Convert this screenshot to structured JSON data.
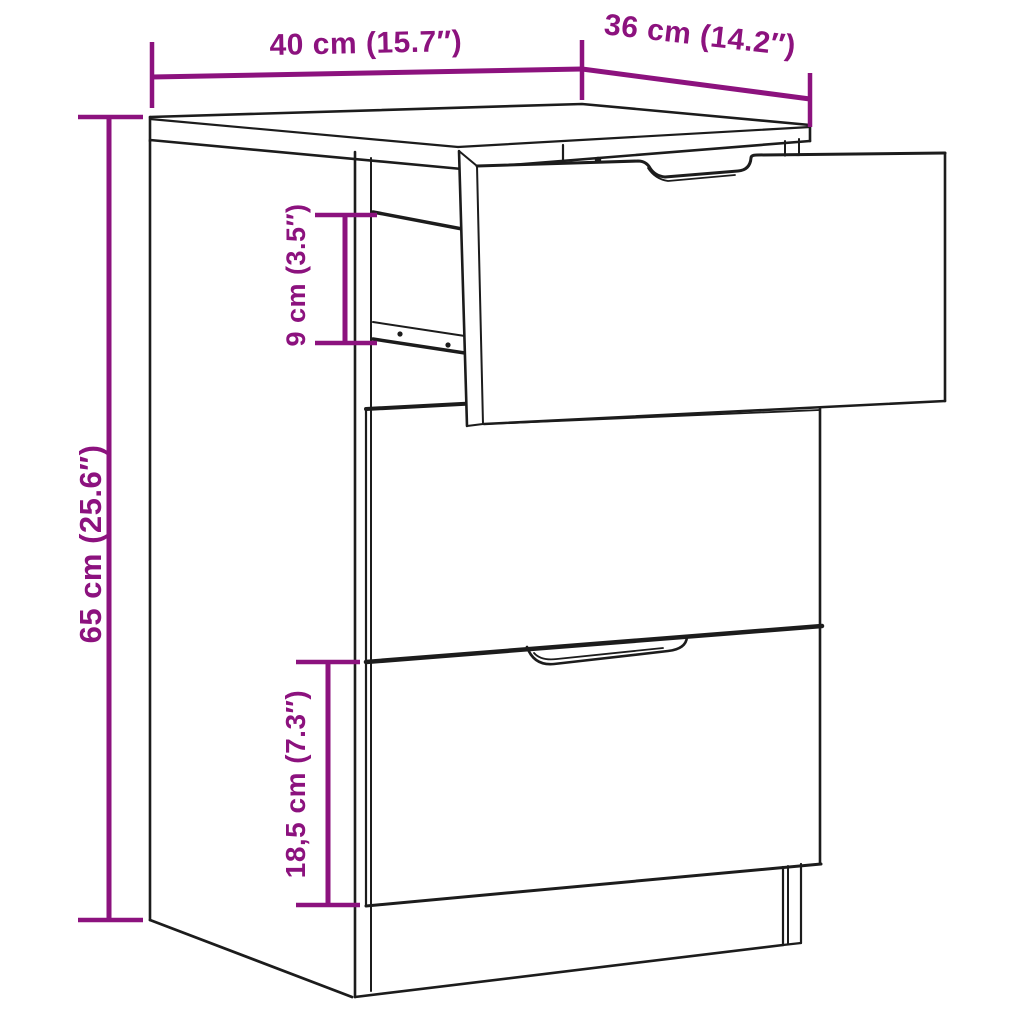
{
  "diagram": {
    "type": "product-dimension-drawing",
    "product": "nightstand-with-three-drawers-top-drawer-open",
    "dimensions": {
      "width": {
        "label": "40 cm (15.7″)",
        "value_cm": "40",
        "value_in": "15.7"
      },
      "depth": {
        "label": "36 cm (14.2″)",
        "value_cm": "36",
        "value_in": "14.2"
      },
      "height": {
        "label": "65 cm (25.6″)",
        "value_cm": "65",
        "value_in": "25.6"
      },
      "drawer_side_height": {
        "label": "9 cm (3.5″)",
        "value_cm": "9",
        "value_in": "3.5"
      },
      "bottom_drawer_height": {
        "label": "18,5 cm (7.3″)",
        "value_cm": "18,5",
        "value_in": "7.3"
      }
    },
    "colors": {
      "dimension_accent": "#8C127E",
      "line_color": "#1c1c1c",
      "background": "#ffffff"
    }
  }
}
